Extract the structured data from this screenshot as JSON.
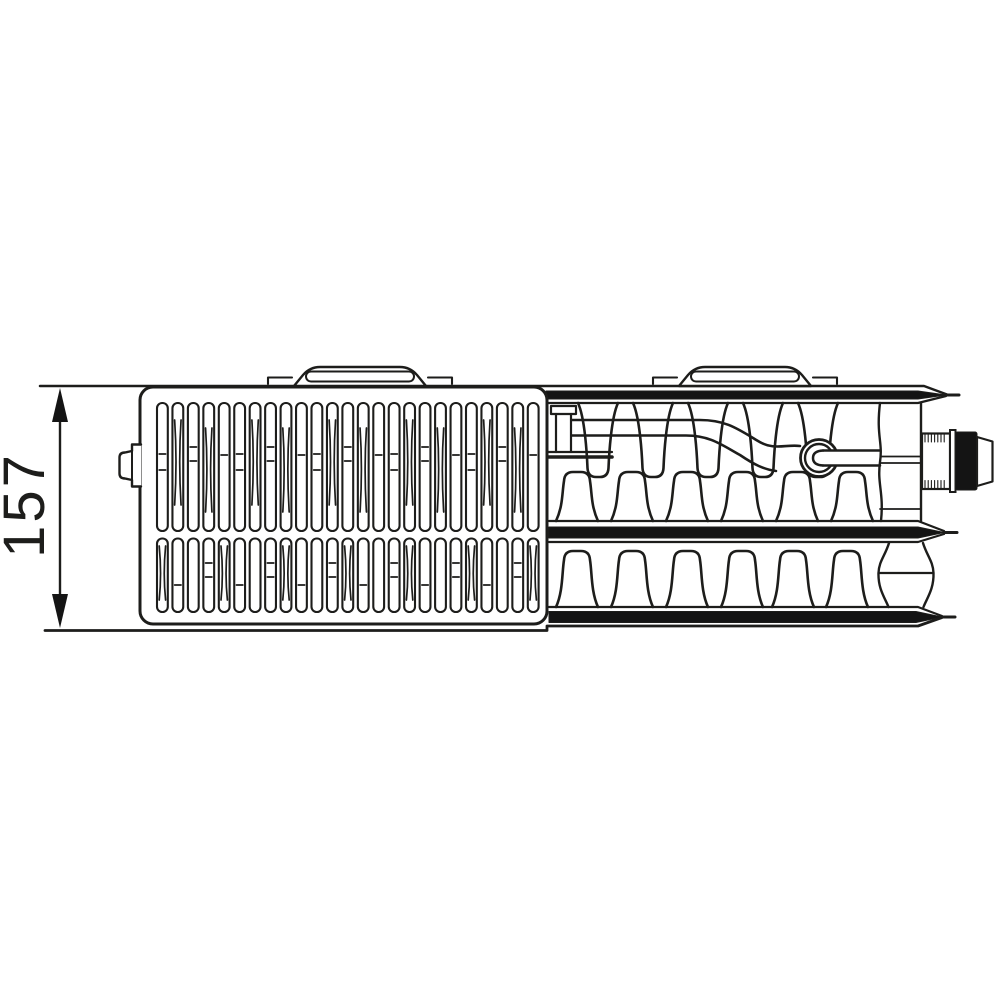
{
  "figure": {
    "type": "technical-drawing",
    "subject": "radiator top view with valve connection",
    "dimension_label": "157"
  },
  "style": {
    "line_color": "#1d1d1b",
    "background_color": "#ffffff",
    "solid_fill_color": "#141414"
  },
  "grille": {
    "slat_count": 25,
    "slat_rows": 2
  },
  "convector": {
    "upper_hanging_fin_count": 5,
    "upper_standing_fin_count": 6,
    "lower_standing_fin_count": 6
  },
  "mounting_brackets": {
    "count": 2
  }
}
